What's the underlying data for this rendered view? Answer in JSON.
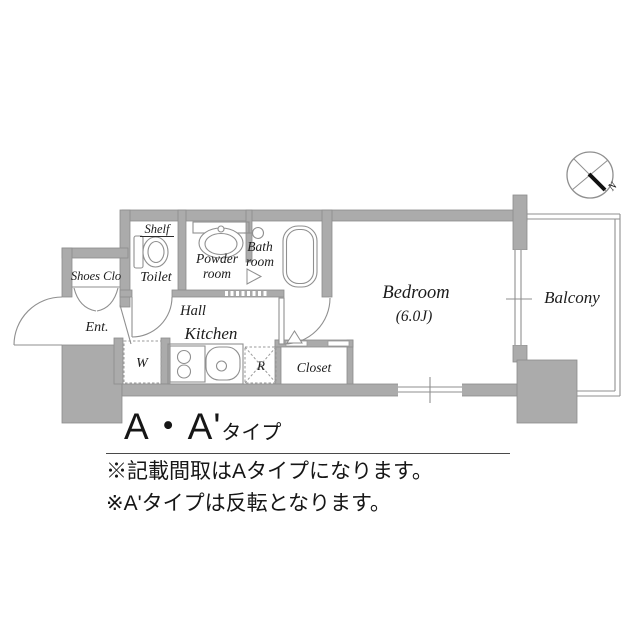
{
  "floor_plan": {
    "compass_label": "N",
    "labels": {
      "shelf": "Shelf",
      "toilet": "Toilet",
      "powder_room_l1": "Powder",
      "powder_room_l2": "room",
      "bath_room_l1": "Bath",
      "bath_room_l2": "room",
      "shoes_closet": "Shoes Clo",
      "entrance": "Ent.",
      "hall": "Hall",
      "kitchen": "Kitchen",
      "washer": "W",
      "refrigerator": "R",
      "closet": "Closet",
      "bedroom": "Bedroom",
      "bedroom_size": "(6.0J)",
      "balcony": "Balcony"
    },
    "colors": {
      "wall_fill": "#ababab",
      "wall_edge": "#8c8c8c",
      "line": "#8f8f8f",
      "text": "#1c1c1c"
    }
  },
  "caption": {
    "title_main": "A・A'",
    "title_suffix": "タイプ",
    "notes": [
      "※記載間取はAタイプになります。",
      "※A'タイプは反転となります。"
    ]
  }
}
